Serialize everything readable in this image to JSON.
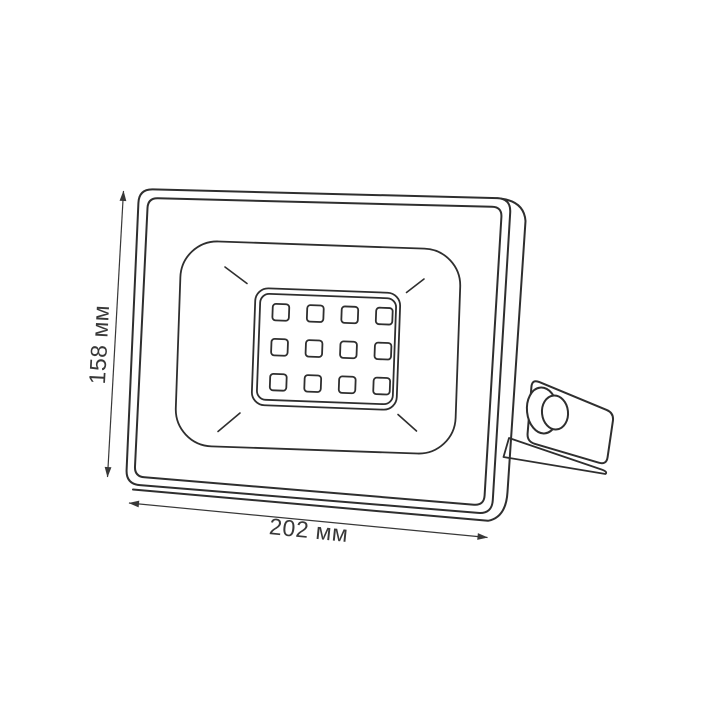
{
  "page": {
    "background_color": "#ffffff"
  },
  "diagram": {
    "type": "product-dimension-drawing",
    "subject": "led-floodlight",
    "stroke_color": "#2f2f2f",
    "dim_color": "#383838",
    "dimensions": {
      "height": "158 мм",
      "width": "202 мм"
    },
    "led_grid": {
      "rows": 3,
      "cols": 4
    }
  }
}
